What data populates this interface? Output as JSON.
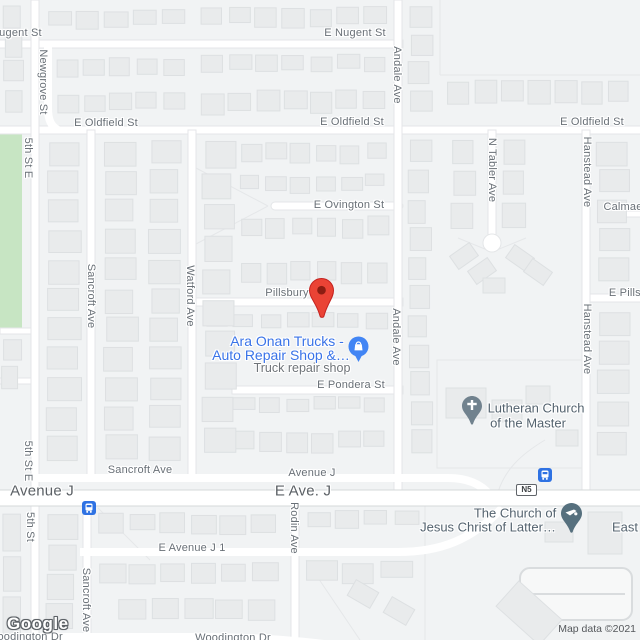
{
  "map": {
    "marker": {
      "label": "red-map-pin",
      "x": 321,
      "y": 318
    },
    "streets": {
      "labels": [
        {
          "text": "E Nugent St",
          "x": 11,
          "y": 33,
          "rot": 0,
          "size": 11
        },
        {
          "text": "E Nugent St",
          "x": 355,
          "y": 33,
          "rot": 0,
          "size": 11
        },
        {
          "text": "E Oldfield St",
          "x": 106,
          "y": 123,
          "rot": 0,
          "size": 11
        },
        {
          "text": "E Oldfield St",
          "x": 352,
          "y": 122,
          "rot": 0,
          "size": 11
        },
        {
          "text": "E Oldfield St",
          "x": 592,
          "y": 122,
          "rot": 0,
          "size": 11
        },
        {
          "text": "E Ovington St",
          "x": 349,
          "y": 205,
          "rot": 0,
          "size": 11
        },
        {
          "text": "Pillsbury St",
          "x": 294,
          "y": 293,
          "rot": 0,
          "size": 11
        },
        {
          "text": "E Pillsbury St",
          "x": 643,
          "y": 293,
          "rot": 0,
          "size": 11
        },
        {
          "text": "Calmae",
          "x": 623,
          "y": 207,
          "rot": 0,
          "size": 11
        },
        {
          "text": "E Pondera St",
          "x": 351,
          "y": 385,
          "rot": 0,
          "size": 11
        },
        {
          "text": "Sancroft Ave",
          "x": 140,
          "y": 470,
          "rot": 0,
          "size": 11
        },
        {
          "text": "Avenue J",
          "x": 312,
          "y": 473,
          "rot": 0,
          "size": 11
        },
        {
          "text": "Avenue J",
          "x": 42,
          "y": 491,
          "rot": 0,
          "size": 15
        },
        {
          "text": "E Ave. J",
          "x": 303,
          "y": 491,
          "rot": 0,
          "size": 15
        },
        {
          "text": "E Avenue J 1",
          "x": 192,
          "y": 548,
          "rot": 0,
          "size": 11
        },
        {
          "text": "Woodington Dr",
          "x": 25,
          "y": 637,
          "rot": 0,
          "size": 11
        },
        {
          "text": "Woodington Dr",
          "x": 233,
          "y": 638,
          "rot": 0,
          "size": 11
        },
        {
          "text": "5th St E",
          "x": 28,
          "y": 158,
          "rot": 90,
          "size": 11
        },
        {
          "text": "5th St E",
          "x": 28,
          "y": 461,
          "rot": 90,
          "size": 11
        },
        {
          "text": "5th St",
          "x": 30,
          "y": 527,
          "rot": 90,
          "size": 11
        },
        {
          "text": "Newgrove St",
          "x": 43,
          "y": 82,
          "rot": 90,
          "size": 11
        },
        {
          "text": "Sancroft Ave",
          "x": 91,
          "y": 296,
          "rot": 90,
          "size": 11
        },
        {
          "text": "Sancroft Ave",
          "x": 86,
          "y": 600,
          "rot": 90,
          "size": 11
        },
        {
          "text": "Watford Ave",
          "x": 190,
          "y": 296,
          "rot": 90,
          "size": 11
        },
        {
          "text": "Andale Ave",
          "x": 397,
          "y": 75,
          "rot": 90,
          "size": 11
        },
        {
          "text": "Andale Ave",
          "x": 396,
          "y": 337,
          "rot": 90,
          "size": 11
        },
        {
          "text": "N Tabler Ave",
          "x": 492,
          "y": 170,
          "rot": 90,
          "size": 11
        },
        {
          "text": "Hanstead Ave",
          "x": 587,
          "y": 172,
          "rot": 90,
          "size": 11
        },
        {
          "text": "Hanstead Ave",
          "x": 587,
          "y": 339,
          "rot": 90,
          "size": 11
        },
        {
          "text": "Rodin Ave",
          "x": 294,
          "y": 528,
          "rot": 90,
          "size": 11
        }
      ]
    },
    "pois": {
      "ara": {
        "line1": "Ara Onan Trucks -",
        "line2": "Auto Repair Shop &…",
        "category": "Truck repair shop"
      },
      "lutheran": {
        "line1": "Lutheran Church",
        "line2": "of the Master"
      },
      "lds": {
        "line1": "The Church of",
        "line2": "Jesus Christ of Latter…"
      },
      "east_truncated": {
        "text": "East"
      }
    },
    "transit": {
      "bus_stops": [
        {
          "x": 82,
          "y": 501
        },
        {
          "x": 538,
          "y": 468
        }
      ],
      "route_badge": {
        "text": "N5",
        "x": 516,
        "y": 484
      }
    },
    "branding": {
      "logo": "Google",
      "attribution": "Map data ©2021"
    },
    "colors": {
      "block": "#f1f3f4",
      "road": "#ffffff",
      "building": "#e9ebec",
      "building_border": "#dde0e2",
      "park": "#c7e5c3",
      "street_gray": "#697077",
      "poi_dark": "#54636f",
      "biz_blue": "#3973e8",
      "marker_red": "#ea4335",
      "marker_red_dark": "#8c1d12",
      "transit_blue": "#2f72e3",
      "church_pin": "#71828e",
      "lds_pin": "#56707e",
      "store_pin": "#4285f4"
    }
  }
}
